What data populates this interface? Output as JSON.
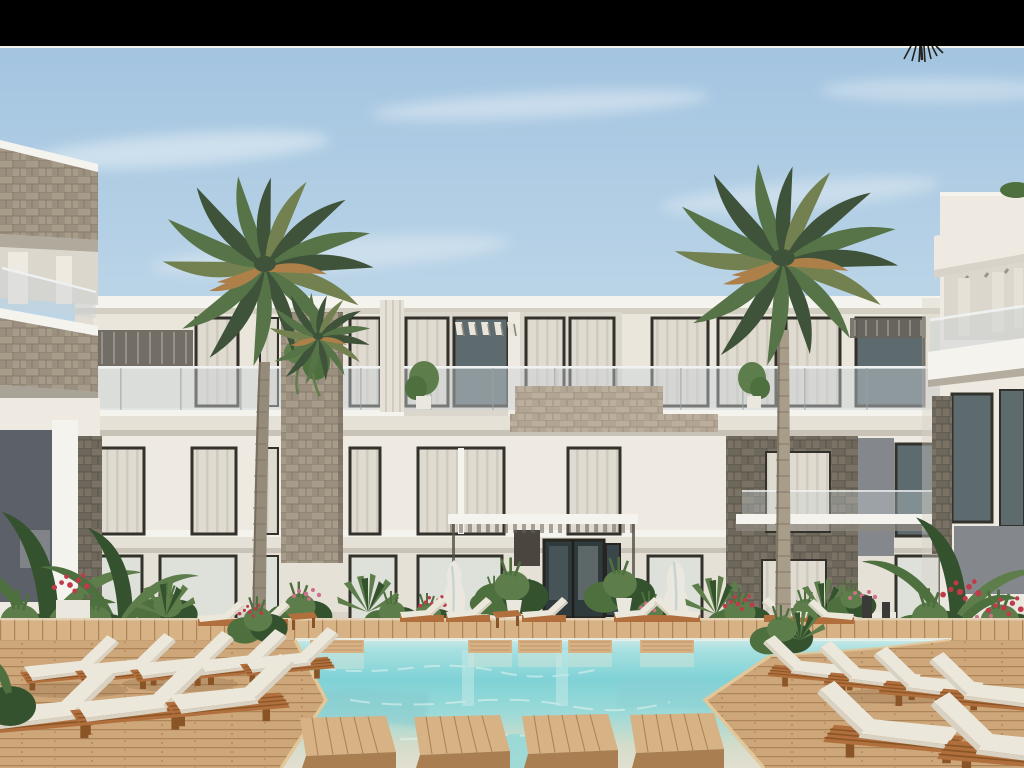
{
  "scene": {
    "type": "architectural-exterior-render",
    "description": "Daytime render of a modern three-storey white resort apartment building with glass balconies, stone-clad accent panels and pergolas, framed by two tall palm trees, with a turquoise swimming pool, wooden decks, stepping platforms and rows of white cushioned sun loungers in the foreground; side wings of neighbouring buildings at the left and right edges; black letterbox bar across the top of the image; no visible text or UI elements.",
    "elements": [
      "letterbox-bar",
      "sky",
      "clouds",
      "main-building",
      "left-building",
      "right-building",
      "pergolas",
      "stone-panels",
      "balcony-glass",
      "entrance-doors",
      "canopy",
      "left-palm-tree",
      "right-palm-tree",
      "small-palm",
      "swimming-pool",
      "wood-platforms",
      "left-deck",
      "right-deck",
      "sun-loungers",
      "side-tables",
      "planting",
      "flower-planters",
      "fountain-sculptures",
      "light-bollards"
    ]
  },
  "letterbox": {
    "position": "top",
    "height_px": 46
  },
  "counts": {
    "floors": 3,
    "left_loungers": 8,
    "right_loungers": 6,
    "background_loungers": 9,
    "pool_platforms": 4
  },
  "colors": {
    "letterbox": "#000000",
    "letterbox_edge": "#f2f1ee",
    "sky_top": "#a3c4e0",
    "sky_mid": "#c3daea",
    "sky_horizon": "#deebf2",
    "cloud": "#eef5f8",
    "wall_light": "#eeeae2",
    "wall_mid": "#e6e1d6",
    "wall_shadow": "#d8d3c8",
    "wall_highlight": "#f5f3ed",
    "slab_shadow": "#c9c3b7",
    "recess": "#dcd7cc",
    "window_frame": "#33312c",
    "glass_dark": "#5d6a6e",
    "glass_light": "#dee0da",
    "curtain": "#e0dbd1",
    "curtain_shade": "#d1cbbf",
    "balcony_glass": "#c9d3d6",
    "rail": "#f0f2f2",
    "pergola_dark": "#67635a",
    "stone_light": "#9b8f7f",
    "stone_light2": "#a79b8a",
    "stone_line": "#877b6b",
    "stone_dark": "#6e675c",
    "stone_dark2": "#7a7265",
    "stone_dark_line": "#5b5449",
    "stone_tan": "#b2a593",
    "stone_tan2": "#bcae9c",
    "stone_tan_line": "#9d9080",
    "trunk": "#948b7b",
    "trunk_light": "#a89d88",
    "palm_dark": "#3e5339",
    "palm_mid": "#567447",
    "palm_olive": "#72814f",
    "palm_dry": "#ad8049",
    "pool_far": "#cfeae8",
    "pool_light": "#a8e0e0",
    "pool_deep": "#7fd2d6",
    "pool_mid": "#9cdad8",
    "pool_shallow": "#d3dcc9",
    "pool_edge": "#e2dfd0",
    "deck": "#cda67a",
    "deck_light": "#d6b285",
    "deck_dark": "#a97f52",
    "deck_line": "#ad8458",
    "lounger_wood": "#b06f3c",
    "lounger_wood_dark": "#8a5526",
    "cushion": "#ece7db",
    "cushion_shadow": "#d9d2c3",
    "leaf_dark": "#35522f",
    "leaf_mid": "#4e6f3e",
    "leaf_light": "#5d7d4a",
    "flower_red": "#c03a4a",
    "flower_pink": "#cf6f8b",
    "planter_white": "#eae7df",
    "accent_gray": "#84888c",
    "accent_dark": "#5c6068",
    "bollard": "#3a3a38"
  }
}
